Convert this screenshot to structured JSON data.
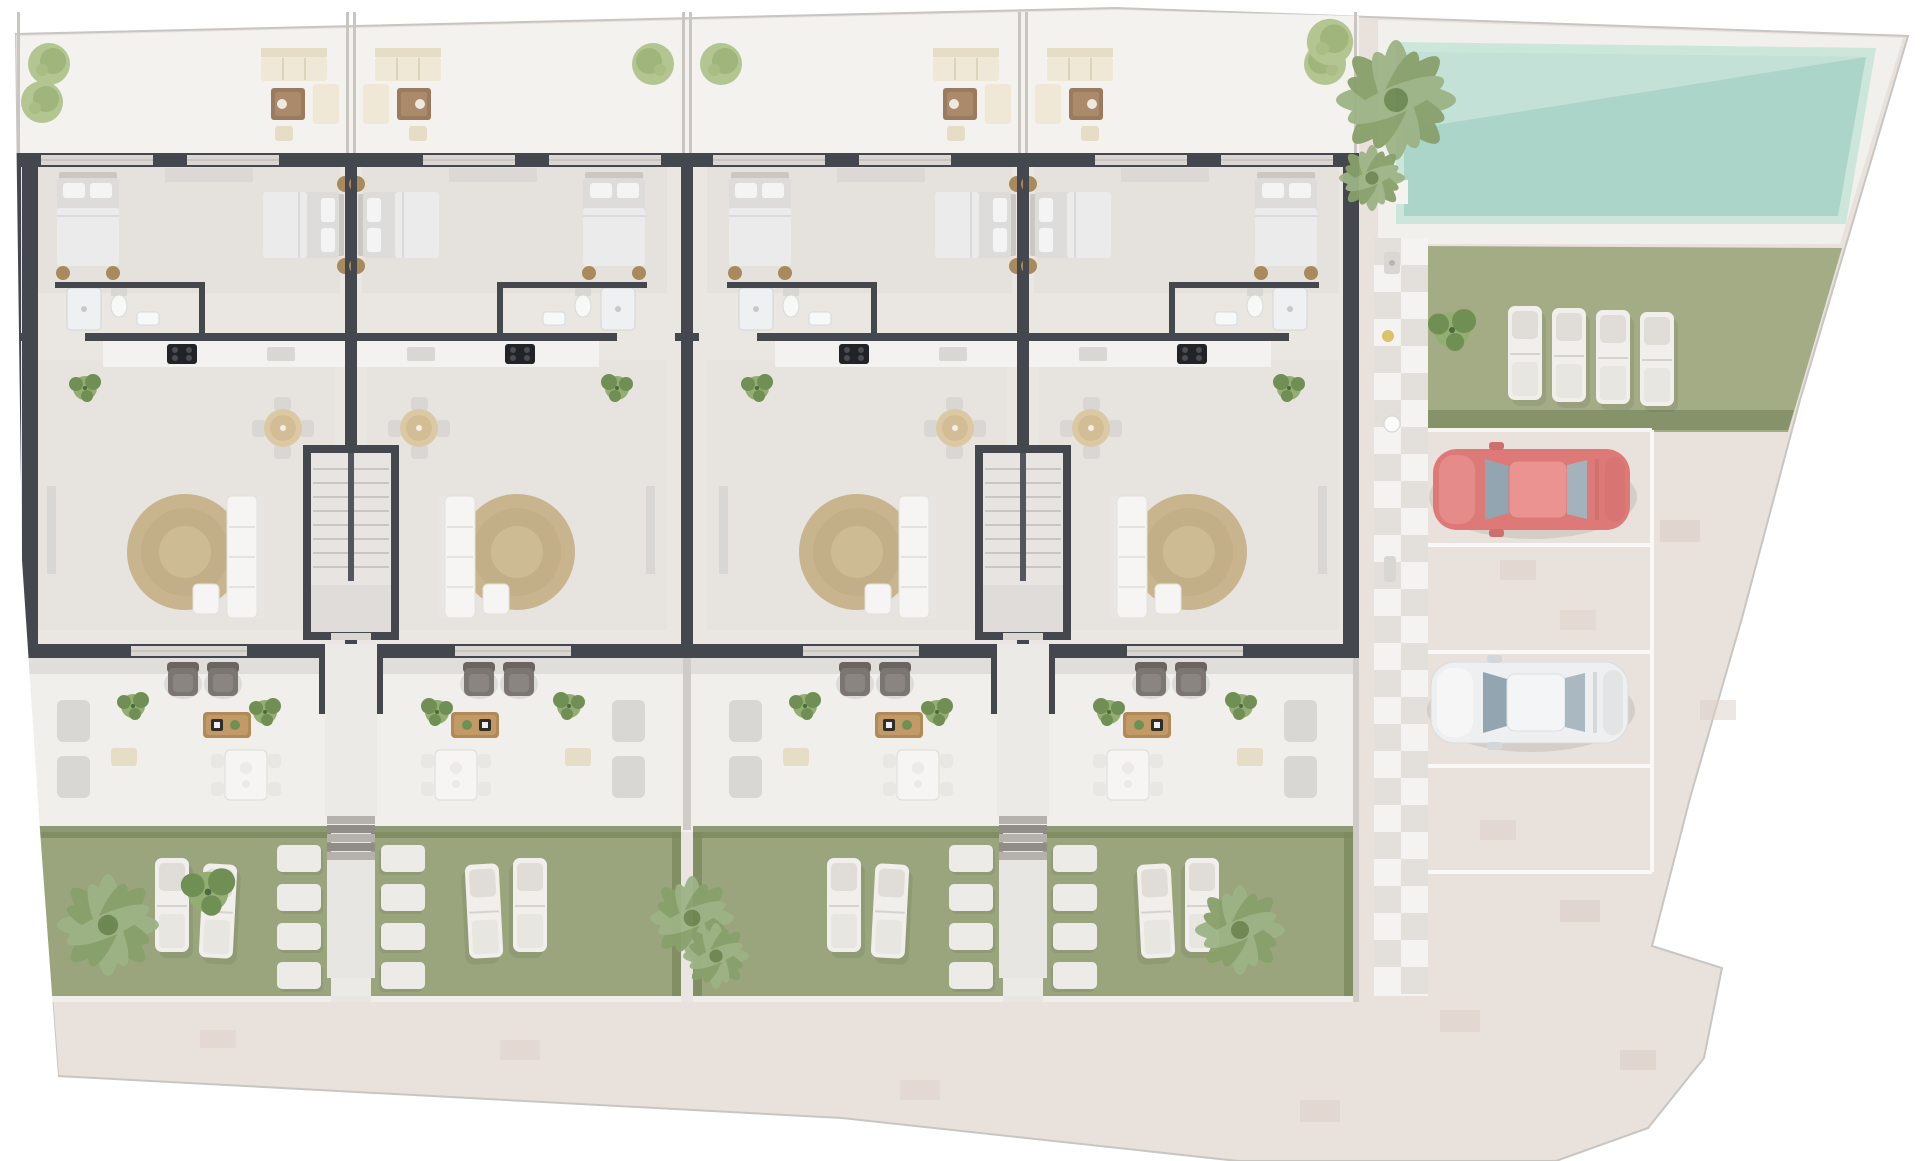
{
  "scene": {
    "type": "aerial 3D architectural site plan, ground floor, faded render",
    "building": {
      "unit_count": 4,
      "unit_pairs": 2,
      "unit_features": [
        "two bedrooms",
        "bathroom",
        "kitchen with cooktop",
        "living-dining room",
        "round jute rug",
        "central stair core",
        "front terrace with sofa set",
        "rear terrace with armchairs and dining set",
        "private garden"
      ]
    },
    "gardens": {
      "private_gardens": 4,
      "sun_loungers_per_garden": 2,
      "stepping_stones_per_column": 4,
      "palm_clusters": 3
    },
    "pool_area": {
      "swimming_pool": 1,
      "lawn_sun_loungers": 4,
      "palm_trees": 1,
      "round_trees": 1,
      "checker_tile_walkway": true
    },
    "parking": {
      "stalls": 4,
      "occupied_stalls": 2,
      "cars": [
        {
          "name": "red-car",
          "stall": 1
        },
        {
          "name": "white-car",
          "stall": 3
        }
      ]
    },
    "paving": "brick driveway and perimeter walkway"
  },
  "palette": {
    "page_bg": "#ffffff",
    "brick": "#e9e1db",
    "brick_shade": "#d9ccc4",
    "terrace_top": "#f3f2ef",
    "floor": "#eae6e2",
    "terrace_low": "#f0efec",
    "garden_base": "#e9e6e2",
    "garden": "#9aa57d",
    "hedge": "#7c895f",
    "lawn": "#a4ac86",
    "pool_deck": "#f1f0ed",
    "pool_light": "#cde6db",
    "pool_main": "#abd5c8",
    "wall": "#45474e",
    "window": "#d9d6d3",
    "rug": "#c8b58e",
    "lounger": "#f0efeb",
    "car_red": "#dd7a78",
    "car_white": "#edeff0",
    "glass": "#93a5b0",
    "checker": "#e3dfda",
    "stall_line": "#fafaf8"
  }
}
